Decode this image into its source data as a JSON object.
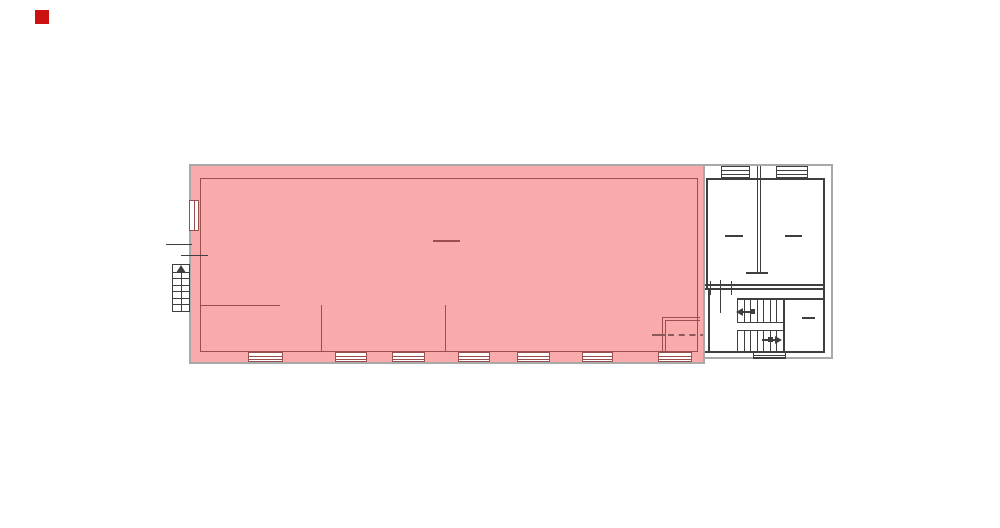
{
  "meta": {
    "description": "Architectural floor plan with one large highlighted (selected) hall area and a right-hand wing containing two rooms and a stairwell",
    "legend_marker_color": "#cc1111"
  },
  "colors": {
    "highlight_fill": "#f9abab",
    "highlight_line": "#9a4f4f",
    "outer_wall_gray": "#a9a9a9",
    "plan_line_dark": "#3f3f3f",
    "marker_red": "#cc1111",
    "dashed_line": "#8a5a5a",
    "paper_white": "#ffffff"
  },
  "marker": {
    "x": 35,
    "y": 10,
    "size": 14
  },
  "plan": {
    "highlighted_hall": {
      "x": 189,
      "y": 164,
      "w": 516,
      "h": 200
    },
    "hall_inner_outline": {
      "x": 200,
      "y": 178,
      "w": 498,
      "h": 174
    },
    "right_wing_outer": {
      "x": 703,
      "y": 164,
      "w": 130,
      "h": 195
    },
    "bottom_windows": [
      {
        "x": 248,
        "w": 35
      },
      {
        "x": 335,
        "w": 32
      },
      {
        "x": 392,
        "w": 33
      },
      {
        "x": 458,
        "w": 32
      },
      {
        "x": 517,
        "w": 33
      },
      {
        "x": 582,
        "w": 31
      },
      {
        "x": 658,
        "w": 34
      }
    ],
    "bottom_windows_y": 352,
    "bottom_windows_h": 10,
    "left_window": {
      "x": 189,
      "y": 200,
      "w": 10,
      "h": 31
    },
    "top_windows": [
      {
        "x": 721,
        "w": 29
      },
      {
        "x": 776,
        "w": 32
      }
    ],
    "top_windows_y": 166,
    "top_windows_h": 12,
    "exterior_ladder": {
      "x": 172,
      "y": 264,
      "w": 18,
      "h": 48,
      "rungs": 6
    },
    "exterior_line_1": {
      "x": 166,
      "y": 244,
      "w": 26
    },
    "exterior_line_2": {
      "x": 181,
      "y": 255,
      "w": 27
    },
    "partition_horizontal": {
      "x": 200,
      "y": 305,
      "w": 80
    },
    "partition_vertical_1": {
      "x": 321,
      "y": 305,
      "h": 47
    },
    "partition_vertical_2": {
      "x": 445,
      "y": 305,
      "h": 47
    },
    "hall_center_mark": {
      "x": 433,
      "y": 240,
      "w": 27
    },
    "small_room": {
      "x": 662,
      "y": 317,
      "w": 38,
      "h": 35
    },
    "small_room_dashed_line": {
      "solid_x": 652,
      "solid_w": 14,
      "dash_x": 668,
      "dash_w": 49,
      "y": 334
    },
    "stairs": {
      "x0": 737,
      "x1": 783,
      "tread_lines": 8,
      "upper_y": 299,
      "upper_h": 24,
      "lower_y": 331,
      "lower_h": 20,
      "landing_y1": 322,
      "landing_y2": 330
    },
    "room_a_mark": {
      "x": 725,
      "y": 235,
      "w": 18
    },
    "room_b_mark": {
      "x": 785,
      "y": 235,
      "w": 17
    },
    "stair_room_mark": {
      "x": 802,
      "y": 317,
      "w": 13
    },
    "entry_steps": {
      "x": 753,
      "y": 352,
      "w": 33,
      "h": 7
    }
  }
}
